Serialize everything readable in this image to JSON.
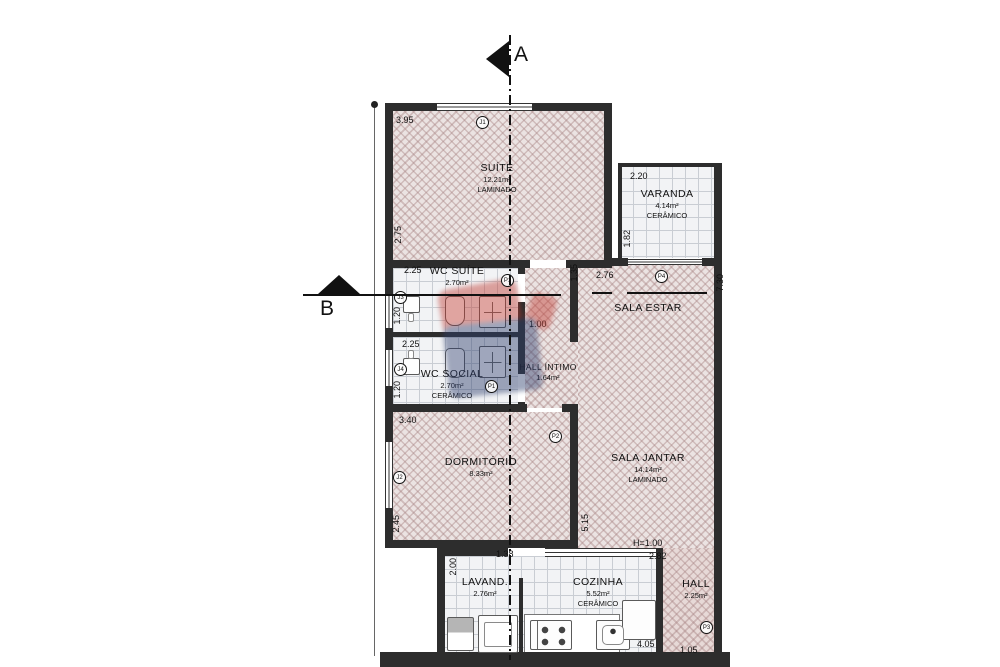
{
  "plan": {
    "section_a": "A",
    "section_b": "B",
    "rooms": {
      "suite": {
        "name": "SUÍTE",
        "area": "12.21m²",
        "floor": "LAMINADO"
      },
      "varanda": {
        "name": "VARANDA",
        "area": "4.14m²",
        "floor": "CERÂMICO"
      },
      "wc_suite": {
        "name": "WC SUÍTE",
        "area": "2.70m²"
      },
      "wc_social": {
        "name": "WC SOCIAL",
        "area": "2.70m²",
        "floor": "CERÂMICO"
      },
      "hall_intimo": {
        "name": "HALL ÍNTIMO",
        "area": "1.64m²"
      },
      "sala_estar": {
        "name": "SALA ESTAR"
      },
      "sala_jantar": {
        "name": "SALA JANTAR",
        "area": "14.14m²",
        "floor": "LAMINADO"
      },
      "dormitorio": {
        "name": "DORMITÓRIO",
        "area": "8.33m²"
      },
      "lavanderia": {
        "name": "LAVAND.",
        "area": "2.76m²"
      },
      "cozinha": {
        "name": "COZINHA",
        "area": "5.52m²",
        "floor": "CERÂMICO"
      },
      "hall": {
        "name": "HALL",
        "area": "2.25m²"
      }
    },
    "dims": {
      "suite_w": "3.95",
      "suite_h": "2.75",
      "varanda_w": "2.20",
      "varanda_h": "1.82",
      "wc_suite_w": "2.25",
      "wc_suite_h": "1.20",
      "wc_social_w": "2.25",
      "wc_social_h": "1.20",
      "sala_estar_w": "2.76",
      "sala_estar_off": "1.35",
      "sala_estar_h": "7.30",
      "hall_intimo_w": "1.00",
      "dorm_w": "3.40",
      "dorm_h": "2.45",
      "jantar_h": "5.15",
      "counter": "H=1.00",
      "cozinha_w": "2.82",
      "lav_h": "2.00",
      "lav_pass": "1.38",
      "cozinha_b": "4.05",
      "hall_b": "1.05"
    },
    "markers": {
      "j1": "J1",
      "j2": "J2",
      "j3": "J3",
      "j4": "J4",
      "p1": "P1",
      "p2": "P2",
      "p3": "P3",
      "p4": "P4"
    },
    "colors": {
      "wall": "#2d2d2d",
      "floor_laminate_hatch": "#ebe3e2",
      "floor_ceramic_tile": "#f2f3f5",
      "watermark_red": "#bf3a31",
      "watermark_blue": "#2e3f6e"
    }
  }
}
